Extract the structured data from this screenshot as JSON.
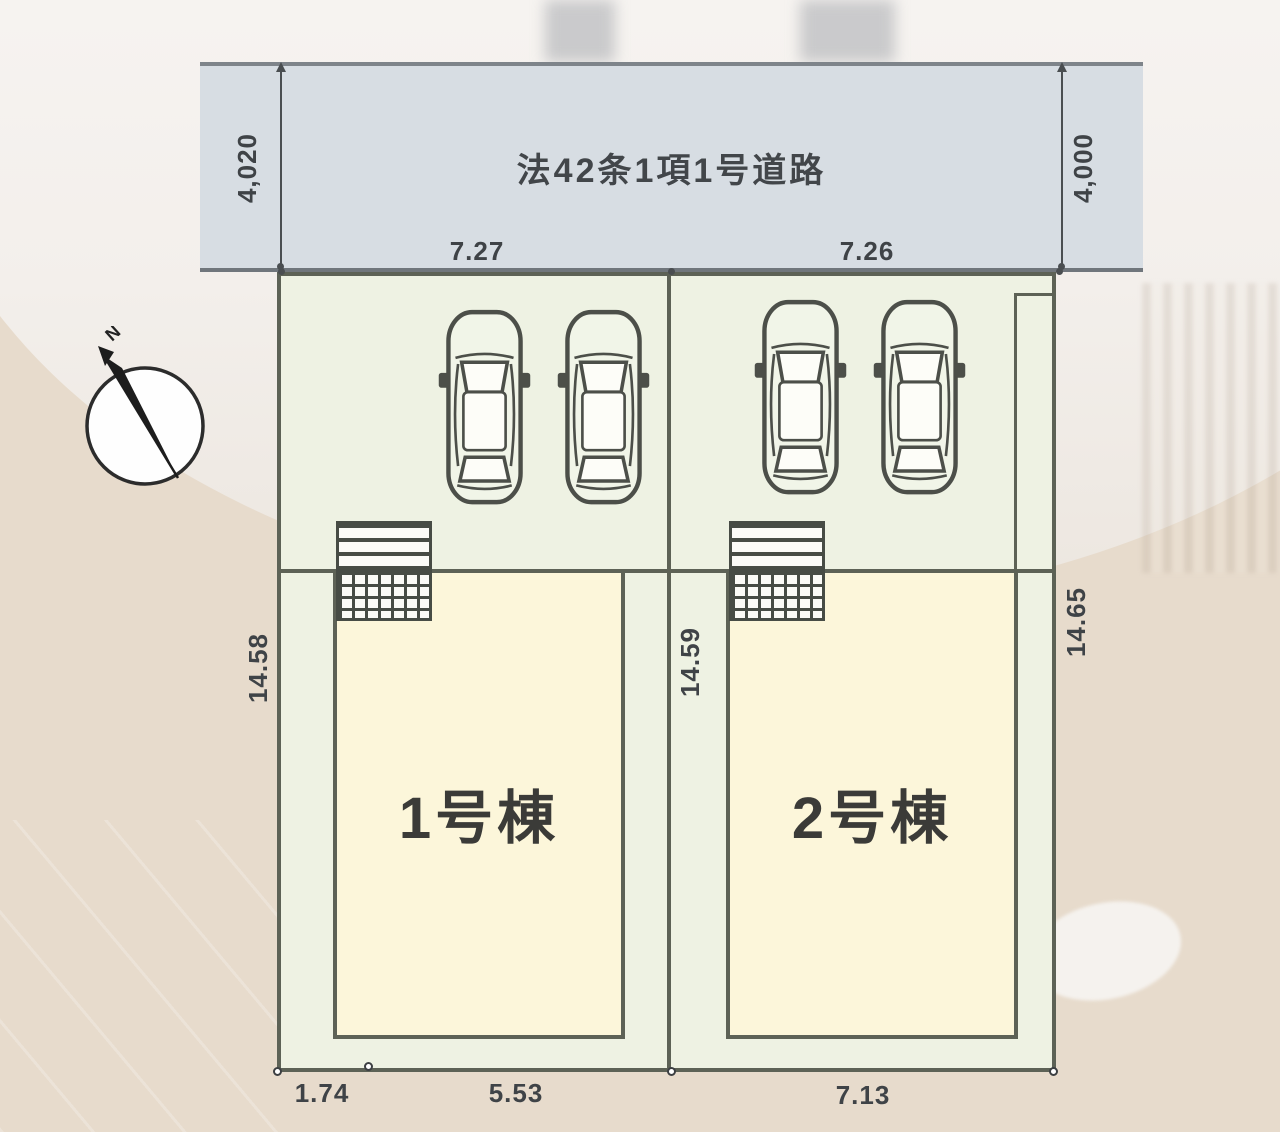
{
  "plan": {
    "road": {
      "label": "法42条1項1号道路"
    },
    "compass": {
      "label": "N"
    },
    "lots": [
      {
        "name": "Lot 1",
        "building_label": "1号棟"
      },
      {
        "name": "Lot 2",
        "building_label": "2号棟"
      }
    ],
    "dimensions": {
      "road_width_left": "4,020",
      "road_width_right": "4,000",
      "frontage_lot1": "7.27",
      "frontage_lot2": "7.26",
      "depth_left": "14.58",
      "depth_center": "14.59",
      "depth_right": "14.65",
      "bottom_offset_lot1": "1.74",
      "bottom_width_lot1": "5.53",
      "bottom_width_lot2": "7.13"
    },
    "colors": {
      "road_fill": "#d7dde3",
      "lot_fill": "#eef2e3",
      "building_fill": "#fcf6da",
      "plan_line": "#5d6256",
      "dimension_text": "#3f4347"
    }
  }
}
